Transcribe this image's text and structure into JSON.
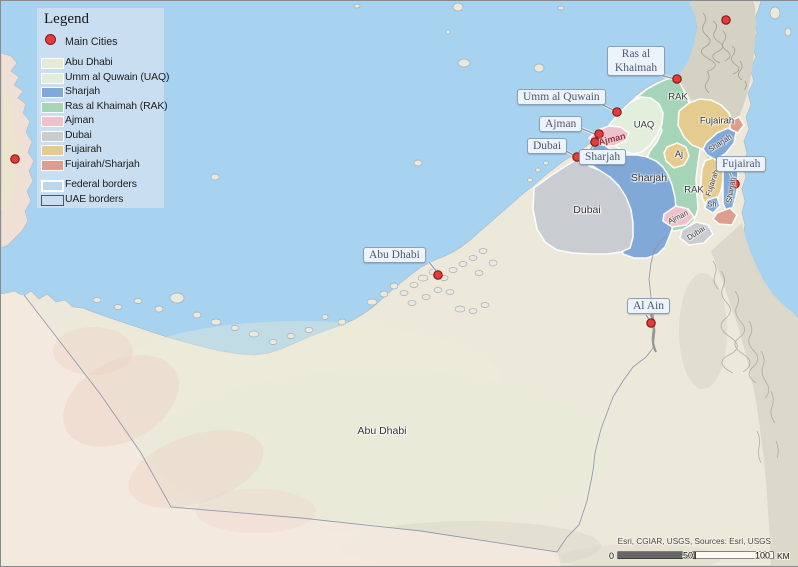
{
  "legend": {
    "title": "Legend",
    "main_cities_label": "Main Cities",
    "items": [
      {
        "label": "Abu Dhabi",
        "color": "#e7e9d9"
      },
      {
        "label": "Umm al Quwain (UAQ)",
        "color": "#e2eedd"
      },
      {
        "label": "Sharjah",
        "color": "#81a9d8"
      },
      {
        "label": "Ras al Khaimah (RAK)",
        "color": "#a5d4b8"
      },
      {
        "label": "Ajman",
        "color": "#eec2cb"
      },
      {
        "label": "Dubai",
        "color": "#c9ccd1"
      },
      {
        "label": "Fujairah",
        "color": "#e5cc8e"
      },
      {
        "label": "Fujairah/Sharjah",
        "color": "#de9e8d"
      }
    ],
    "federal_borders_label": "Federal borders",
    "uae_borders_label": "UAE borders",
    "marker_color": "#e23c3c"
  },
  "callouts": [
    {
      "id": "ras-al-khaimah",
      "label": "Ras al\nKhaimah"
    },
    {
      "id": "umm-al-quwain",
      "label": "Umm al Quwain"
    },
    {
      "id": "ajman",
      "label": "Ajman"
    },
    {
      "id": "dubai",
      "label": "Dubai"
    },
    {
      "id": "sharjah",
      "label": "Sharjah"
    },
    {
      "id": "abu-dhabi",
      "label": "Abu Dhabi"
    },
    {
      "id": "al-ain",
      "label": "Al Ain"
    },
    {
      "id": "fujairah",
      "label": "Fujairah"
    }
  ],
  "map_labels": [
    {
      "text": "Abu Dhabi"
    },
    {
      "text": "Dubai"
    },
    {
      "text": "Sharjah"
    },
    {
      "text": "UAQ"
    },
    {
      "text": "RAK"
    },
    {
      "text": "RAK"
    },
    {
      "text": "Fujairah"
    },
    {
      "text": "Aj"
    },
    {
      "text": "Ajman"
    },
    {
      "text": "Sharjah"
    },
    {
      "text": "Fujairah"
    },
    {
      "text": "Sharjah"
    },
    {
      "text": "Sh"
    },
    {
      "text": "Ajman"
    },
    {
      "text": "Dubai"
    }
  ],
  "scalebar": {
    "start": "0",
    "mid": "50",
    "end": "100",
    "unit": "KM"
  },
  "attribution": "Esri, CGIAR, USGS, Sources: Esri, USGS"
}
